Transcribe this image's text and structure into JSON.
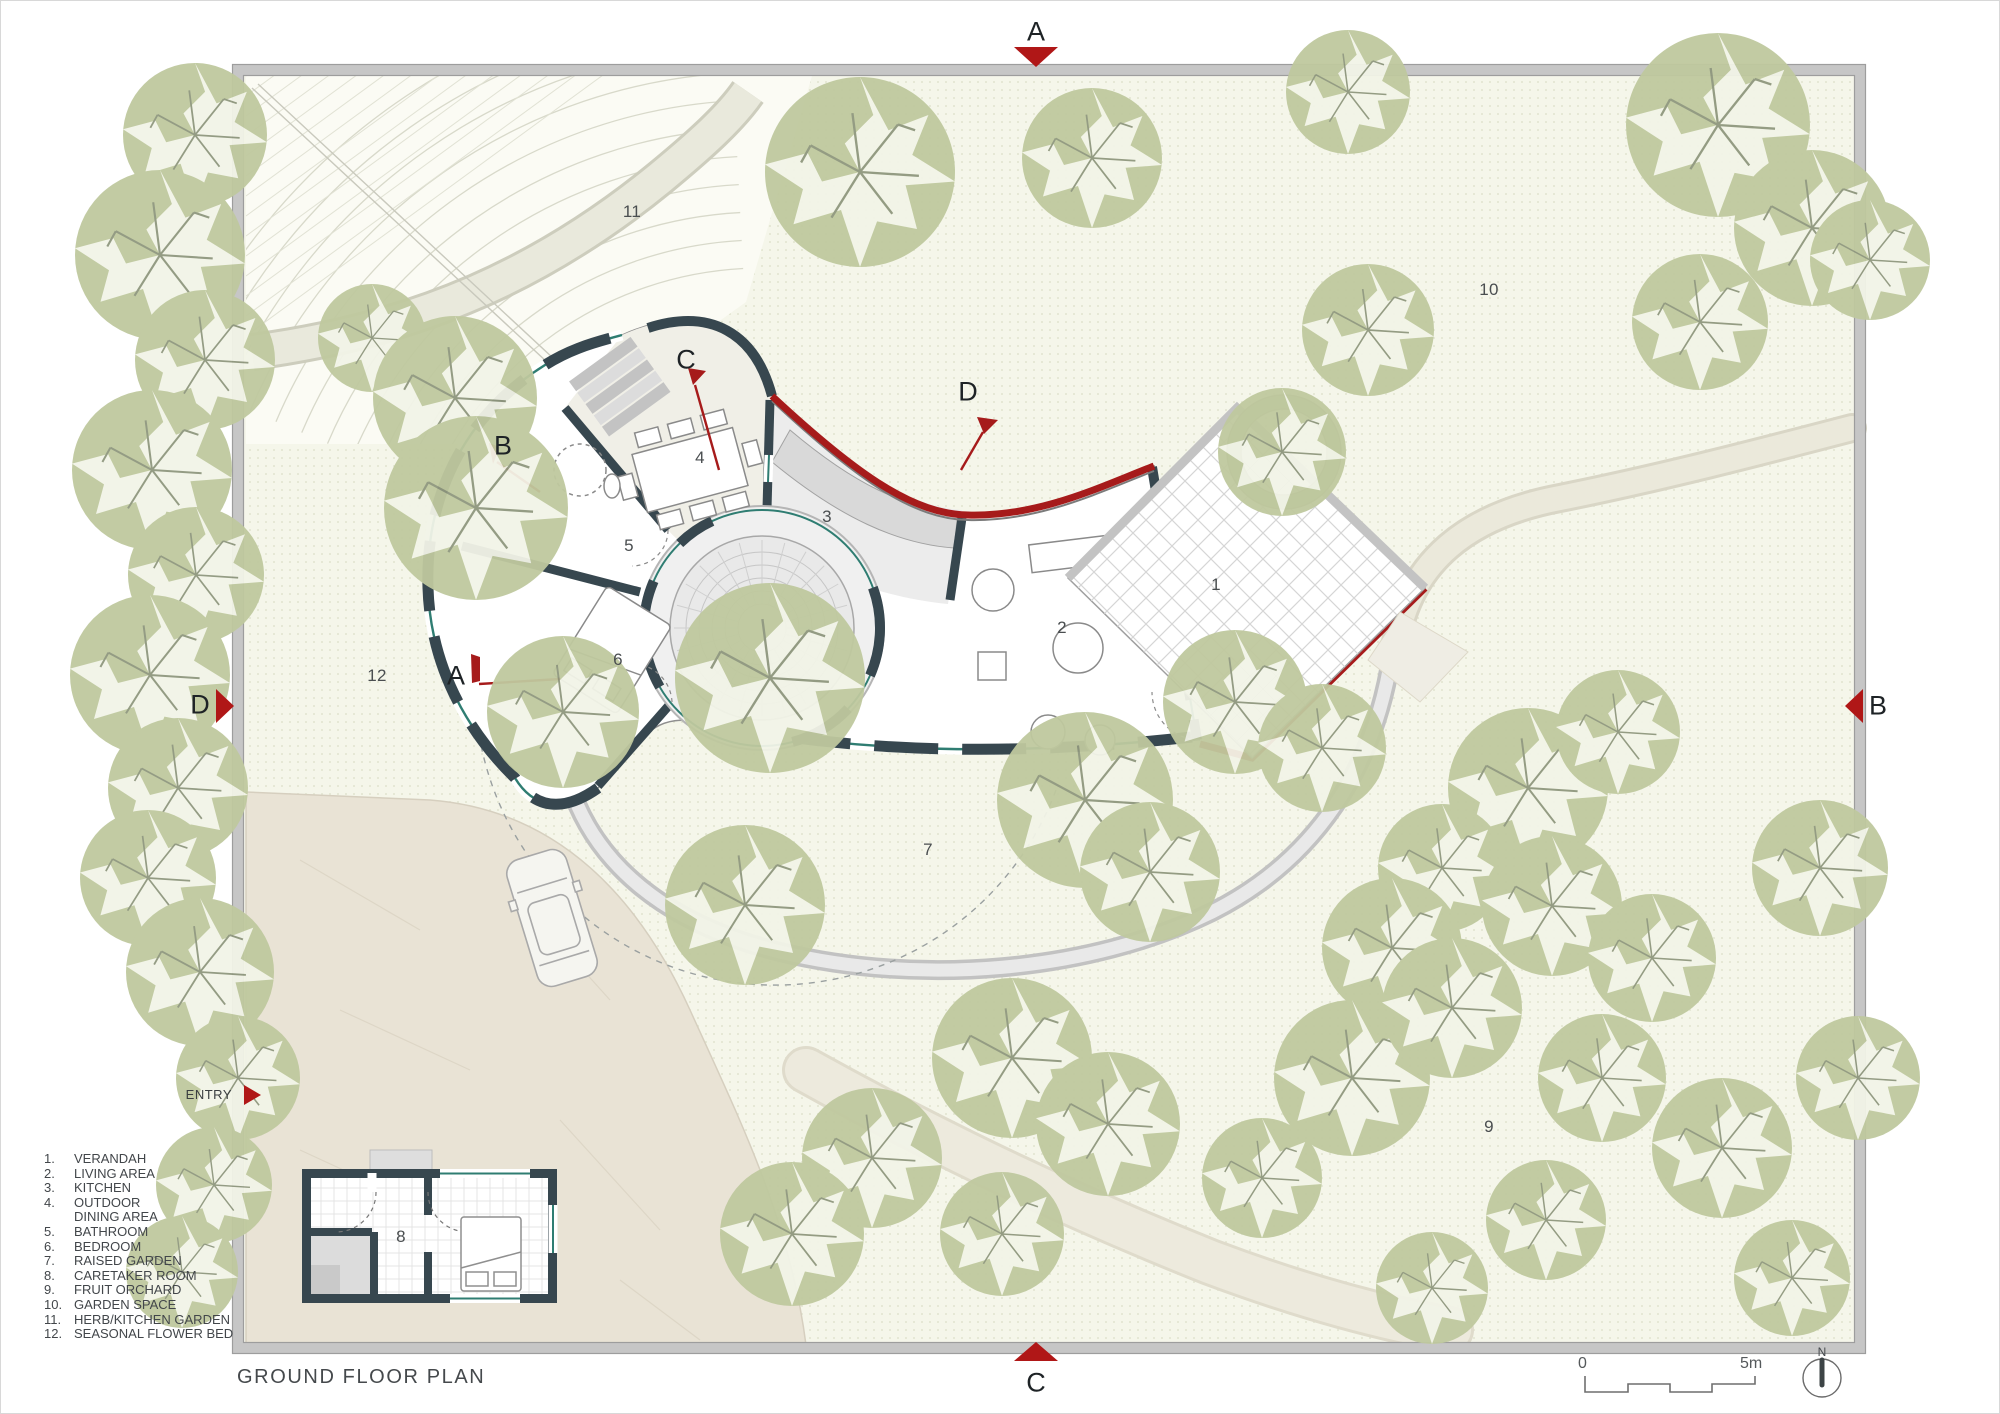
{
  "title": "GROUND FLOOR PLAN",
  "entry": {
    "label": "ENTRY"
  },
  "north_label": "N",
  "scale_bar": {
    "start": "0",
    "end": "5m"
  },
  "section_markers": {
    "top": {
      "label": "A"
    },
    "bottom": {
      "label": "C"
    },
    "left": {
      "label": "D"
    },
    "right": {
      "label": "B"
    }
  },
  "section_flags": [
    {
      "label": "B",
      "x": 503,
      "y": 446
    },
    {
      "label": "C",
      "x": 686,
      "y": 360
    },
    {
      "label": "D",
      "x": 968,
      "y": 392
    },
    {
      "label": "A",
      "x": 456,
      "y": 676
    }
  ],
  "room_labels": [
    {
      "num": "1",
      "x": 1216,
      "y": 585
    },
    {
      "num": "2",
      "x": 1062,
      "y": 628
    },
    {
      "num": "3",
      "x": 827,
      "y": 517
    },
    {
      "num": "4",
      "x": 700,
      "y": 458
    },
    {
      "num": "5",
      "x": 629,
      "y": 546
    },
    {
      "num": "6",
      "x": 618,
      "y": 660
    },
    {
      "num": "7",
      "x": 928,
      "y": 850
    },
    {
      "num": "8",
      "x": 401,
      "y": 1237
    },
    {
      "num": "9",
      "x": 1489,
      "y": 1127
    },
    {
      "num": "10",
      "x": 1489,
      "y": 290
    },
    {
      "num": "11",
      "x": 632,
      "y": 212
    },
    {
      "num": "12",
      "x": 377,
      "y": 676
    }
  ],
  "legend": {
    "items": [
      {
        "num": "1.",
        "lines": [
          "VERANDAH"
        ]
      },
      {
        "num": "2.",
        "lines": [
          "LIVING AREA"
        ]
      },
      {
        "num": "3.",
        "lines": [
          "KITCHEN"
        ]
      },
      {
        "num": "4.",
        "lines": [
          "OUTDOOR",
          "DINING AREA"
        ]
      },
      {
        "num": "5.",
        "lines": [
          "BATHROOM"
        ]
      },
      {
        "num": "6.",
        "lines": [
          "BEDROOM"
        ]
      },
      {
        "num": "7.",
        "lines": [
          "RAISED GARDEN"
        ]
      },
      {
        "num": "8.",
        "lines": [
          "CARETAKER ROOM"
        ]
      },
      {
        "num": "9.",
        "lines": [
          "FRUIT ORCHARD"
        ]
      },
      {
        "num": "10.",
        "lines": [
          "GARDEN SPACE"
        ]
      },
      {
        "num": "11.",
        "lines": [
          "HERB/KITCHEN GARDEN"
        ]
      },
      {
        "num": "12.",
        "lines": [
          "SEASONAL FLOWER BED"
        ]
      }
    ]
  },
  "colors": {
    "accent_red": "#a61b1b",
    "marker_red": "#b01717",
    "wall_dark": "#37474f",
    "glazing_teal": "#2f7d72",
    "tree_green": "#bfc99f",
    "field_cream": "#f5f6ea",
    "flagstone": "#e9e3d5"
  },
  "trees": [
    [
      195,
      135,
      72
    ],
    [
      160,
      255,
      85
    ],
    [
      205,
      360,
      70
    ],
    [
      152,
      470,
      80
    ],
    [
      196,
      575,
      68
    ],
    [
      150,
      675,
      80
    ],
    [
      178,
      788,
      70
    ],
    [
      148,
      878,
      68
    ],
    [
      200,
      972,
      74
    ],
    [
      238,
      1078,
      62
    ],
    [
      214,
      1185,
      58
    ],
    [
      182,
      1272,
      56
    ],
    [
      372,
      338,
      54
    ],
    [
      455,
      398,
      82
    ],
    [
      476,
      508,
      92
    ],
    [
      860,
      172,
      95
    ],
    [
      1092,
      158,
      70
    ],
    [
      1348,
      92,
      62
    ],
    [
      1718,
      125,
      92
    ],
    [
      1812,
      228,
      78
    ],
    [
      1700,
      322,
      68
    ],
    [
      1368,
      330,
      66
    ],
    [
      1870,
      260,
      60
    ],
    [
      1282,
      452,
      64
    ],
    [
      770,
      678,
      95
    ],
    [
      563,
      712,
      76
    ],
    [
      745,
      905,
      80
    ],
    [
      1085,
      800,
      88
    ],
    [
      1150,
      872,
      70
    ],
    [
      1235,
      702,
      72
    ],
    [
      1322,
      748,
      64
    ],
    [
      1528,
      788,
      80
    ],
    [
      1618,
      732,
      62
    ],
    [
      1820,
      868,
      68
    ],
    [
      1442,
      868,
      64
    ],
    [
      1392,
      948,
      70
    ],
    [
      1552,
      906,
      70
    ],
    [
      1652,
      958,
      64
    ],
    [
      1012,
      1058,
      80
    ],
    [
      1108,
      1124,
      72
    ],
    [
      872,
      1158,
      70
    ],
    [
      792,
      1234,
      72
    ],
    [
      1002,
      1234,
      62
    ],
    [
      1262,
      1178,
      60
    ],
    [
      1352,
      1078,
      78
    ],
    [
      1452,
      1008,
      70
    ],
    [
      1602,
      1078,
      64
    ],
    [
      1722,
      1148,
      70
    ],
    [
      1546,
      1220,
      60
    ],
    [
      1432,
      1288,
      56
    ],
    [
      1792,
      1278,
      58
    ],
    [
      1858,
      1078,
      62
    ]
  ]
}
